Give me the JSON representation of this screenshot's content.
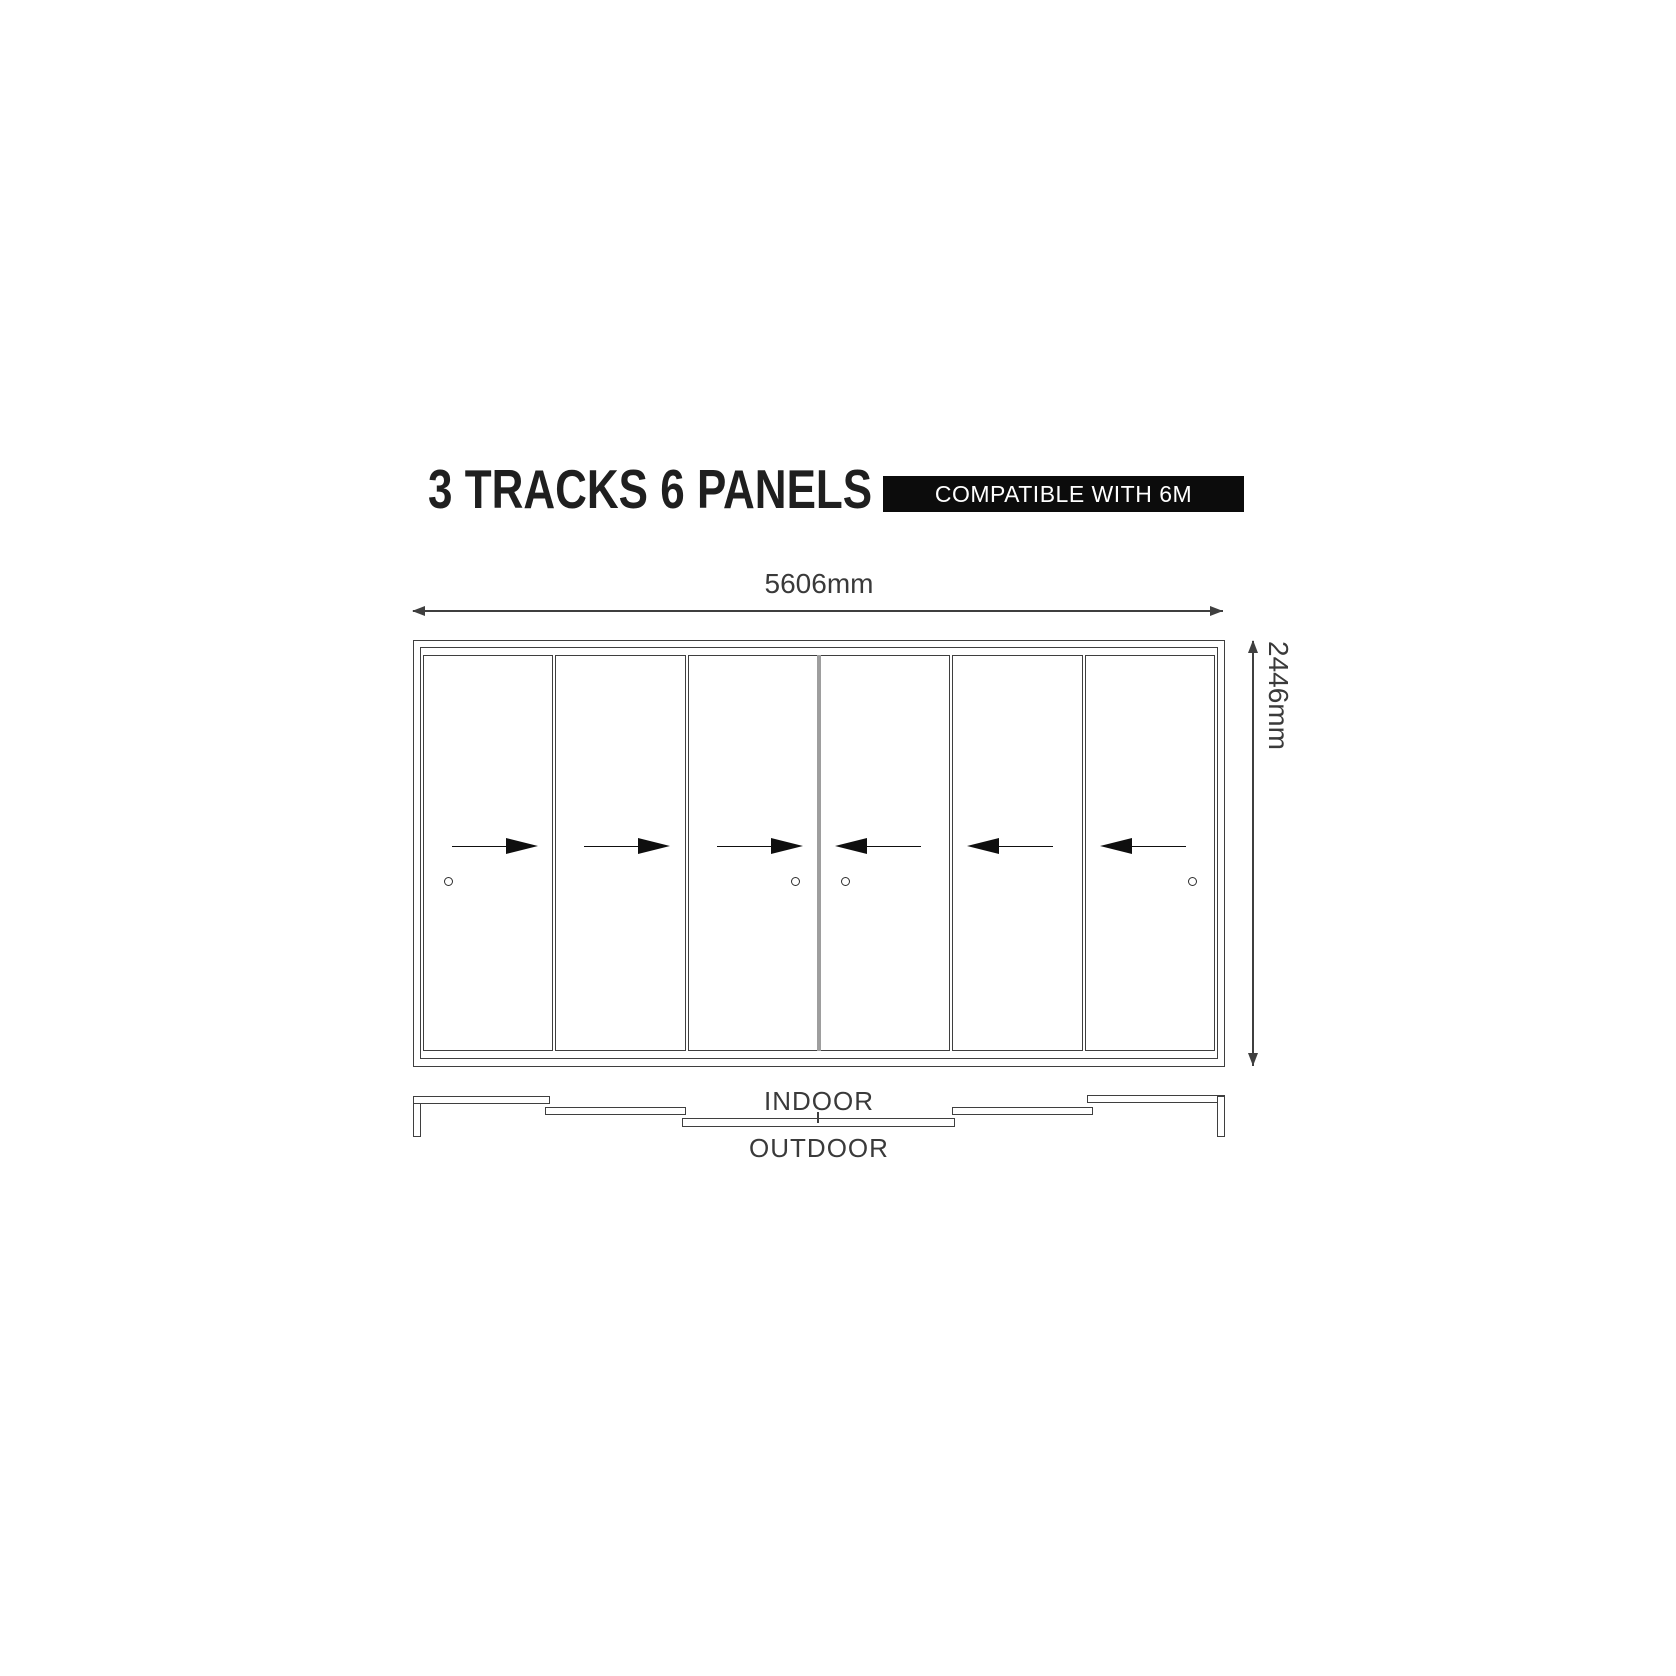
{
  "header": {
    "title": "3 TRACKS 6 PANELS",
    "badge": "COMPATIBLE WITH 6M"
  },
  "dimensions": {
    "width_label": "5606mm",
    "height_label": "2446mm"
  },
  "plan": {
    "indoor_label": "INDOOR",
    "outdoor_label": "OUTDOOR",
    "tracks": 3
  },
  "panels": [
    {
      "id": 1,
      "arrow": "right",
      "handle": "left"
    },
    {
      "id": 2,
      "arrow": "right",
      "handle": null
    },
    {
      "id": 3,
      "arrow": "right",
      "handle": "right"
    },
    {
      "id": 4,
      "arrow": "left",
      "handle": "left"
    },
    {
      "id": 5,
      "arrow": "left",
      "handle": null
    },
    {
      "id": 6,
      "arrow": "left",
      "handle": "right"
    }
  ],
  "colors": {
    "line": "#3f3f3f",
    "text": "#3a3a3a",
    "arrow": "#0f0f0f",
    "badge_bg": "#0c0c0c",
    "badge_fg": "#ffffff",
    "center_divider": "#9e9e9e",
    "title": "#1f1f1f"
  }
}
